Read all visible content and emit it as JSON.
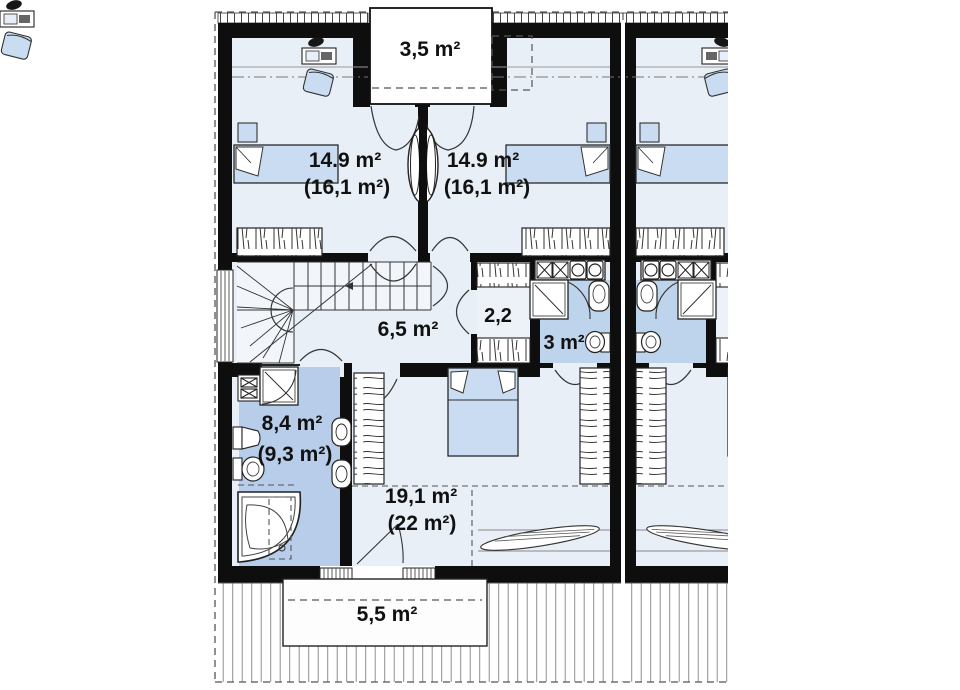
{
  "plan": {
    "type": "floor_plan",
    "rooms": {
      "balcony": {
        "area": "3,5 m²"
      },
      "bedroom_left": {
        "area": "14.9 m²",
        "area_floor": "(16,1 m²)"
      },
      "bedroom_right": {
        "area": "14.9 m²",
        "area_floor": "(16,1 m²)"
      },
      "hall": {
        "area": "6,5 m²"
      },
      "closet": {
        "area": "2,2"
      },
      "bathroom_small": {
        "area": "3 m²"
      },
      "bathroom": {
        "area": "8,4 m²",
        "area_floor": "(9,3 m²)"
      },
      "bedroom_master": {
        "area": "19,1 m²",
        "area_floor": "(22 m²)"
      },
      "terrace": {
        "area": "5,5 m²"
      }
    },
    "colors": {
      "wall": "#0e0e0e",
      "room_fill": "#e9eff7",
      "stair_fill": "#f2f6fb",
      "bathroom_fill": "#b7cde9",
      "bathroom_small_fill": "#bed3ec",
      "furniture_fill": "#c9dcf1",
      "paper": "#ffffff"
    }
  }
}
